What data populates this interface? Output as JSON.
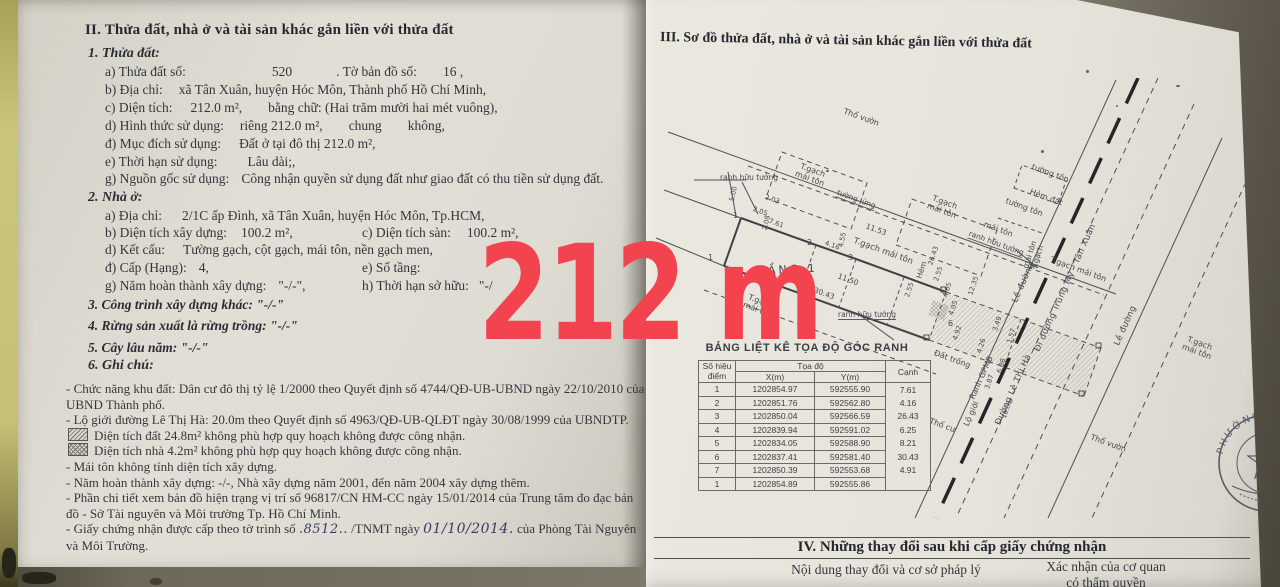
{
  "watermark": {
    "text": "212 m",
    "color": "#f3434f"
  },
  "left": {
    "title": "II. Thửa đất, nhà ở và tài sản khác gắn liền với thửa đất",
    "land_heading": "1. Thửa đất:",
    "land_a_label": "a) Thửa đất số:",
    "land_a_value": "520",
    "land_a_label2": ". Tờ bản đồ số:",
    "land_a_value2": "16 ,",
    "land_b_label": "b) Địa chỉ:",
    "land_b_value": "xã Tân Xuân, huyện Hóc Môn, Thành phố Hồ Chí Minh,",
    "land_c_label": "c) Diện tích:",
    "land_c_value": "212.0 m²,",
    "land_c_words": "bằng chữ: (Hai trăm mười hai mét vuông),",
    "land_d_label": "d) Hình thức sử dụng:",
    "land_d_rieng": "riêng 212.0 m²,",
    "land_d_chung": "chung",
    "land_d_khong": "không,",
    "land_dd_label": "đ) Mục đích sử dụng:",
    "land_dd_value": "Đất ở tại đô thị 212.0 m²,",
    "land_e_label": "e) Thời hạn sử dụng:",
    "land_e_value": "Lâu dài;,",
    "land_g_label": "g) Nguồn gốc sử dụng:",
    "land_g_value": "Công nhận quyền sử dụng đất như giao đất có thu tiền sử dụng đất.",
    "house_heading": "2. Nhà ở:",
    "house_a_label": "a) Địa chỉ:",
    "house_a_value": "2/1C ấp Đình, xã Tân Xuân, huyện Hóc Môn, Tp.HCM,",
    "house_b_label": "b) Diện tích xây dựng:",
    "house_b_value": "100.2 m²,",
    "house_c_label": "c) Diện tích sàn:",
    "house_c_value": "100.2 m²,",
    "house_d_label": "d) Kết cấu:",
    "house_d_value": "Tường gạch, cột gạch, mái tôn, nền gạch men,",
    "house_dd_label": "đ) Cấp (Hạng):",
    "house_dd_value": "4,",
    "house_e_label": "e) Số tầng:",
    "house_g_label": "g) Năm hoàn thành xây dựng:",
    "house_g_value": "\"-/-\",",
    "house_h_label": "h) Thời hạn sở hữu:",
    "house_h_value": "\"-/",
    "item3": "3. Công trình xây dựng khác: \"-/-\"",
    "item4": "4. Rừng sản xuất là rừng trồng: \"-/-\"",
    "item5": "5. Cây lâu năm: \"-/-\"",
    "item6": "6. Ghi chú:",
    "note1": "- Chức năng khu đất: Dân cư đô thị tỷ lệ 1/2000 theo Quyết định số 4744/QĐ-UB-UBND ngày 22/10/2010 của UBND Thành phố.",
    "note2": "- Lộ giới đường Lê Thị Hà: 20.0m theo Quyết định số 4963/QĐ-UB-QLĐT ngày 30/08/1999 của UBNDTP.",
    "note3": "Diện tích đất 24.8m² không phù hợp quy hoạch không được công nhận.",
    "note4": "Diện tích nhà 4.2m² không phù hợp quy hoạch không được công nhận.",
    "note5": "- Mái tôn không tính diện tích xây dựng.",
    "note6": "- Năm hoàn thành xây dựng: -/-, Nhà xây dựng năm 2001, đến năm 2004 xây dựng thêm.",
    "note7": "- Phần chi tiết xem bản đồ hiện trạng vị trí số 96817/CN HM-CC ngày 15/01/2014 của Trung tâm đo đạc bản đồ - Sở Tài nguyên và Môi trường Tp. Hồ Chí Minh.",
    "note8_pre": "- Giấy chứng nhận được cấp theo tờ trình số",
    "note8_hand1": ".8512..",
    "note8_mid": "/TNMT ngày",
    "note8_hand2": "01/10/2014.",
    "note8_post": "của Phòng Tài Nguyên",
    "note8_tail": "và Môi Trường."
  },
  "right": {
    "title": "III. Sơ đồ thửa đất, nhà ở và tài sản khác gắn liền với thửa đất",
    "table": {
      "title": "BẢNG LIỆT KÊ TỌA ĐỘ GÓC RANH",
      "h_point": "Số hiệu\nđiểm",
      "h_coord": "Tọa độ",
      "h_x": "X(m)",
      "h_y": "Y(m)",
      "h_edge": "Cạnh",
      "rows": [
        [
          "1",
          "1202854.97",
          "592555.90",
          "7.61"
        ],
        [
          "2",
          "1202851.76",
          "592562.80",
          "4.16"
        ],
        [
          "3",
          "1202850.04",
          "592566.59",
          "26.43"
        ],
        [
          "4",
          "1202839.94",
          "592591.02",
          "6.25"
        ],
        [
          "5",
          "1202834.05",
          "592588.90",
          "8.21"
        ],
        [
          "6",
          "1202837.41",
          "592581.40",
          "30.43"
        ],
        [
          "7",
          "1202850.39",
          "592553.68",
          "4.91"
        ],
        [
          "1",
          "1202854.89",
          "592555.86",
          ""
        ]
      ]
    },
    "sec4": {
      "title": "IV. Những thay đổi sau khi cấp giấy chứng nhận",
      "col1": "Nội dung thay đổi và cơ sở pháp lý",
      "col2a": "Xác nhận của cơ quan",
      "col2b": "có thẩm quyền"
    },
    "stamp_text": "PHƯỜNG HÒA BÌNH",
    "diagram": {
      "tho_vuon_top": "Thổ vườn",
      "hem_dat": "Hẻm đất",
      "tgach1": "T.gạch\nmái tôn",
      "tgach2": "T.gạch\nmái tôn",
      "tgach3": "T.gạch mái tôn",
      "tgach4": "T.gạch\nmái tôn",
      "tgach5": "T.gạch\nmái tôn",
      "tgach_plot": "T.gạch mái tôn",
      "mai_ton1": "mái tôn",
      "mai_ton2": "mái tôn\nT.gạch",
      "tuong_lung": "tường lửng",
      "tuong_ton1": "tường tôn",
      "tuong_ton2": "tường tôn",
      "ranh1": "ranh hữu tưởng",
      "ranh2": "ranh hữu tưởng",
      "ranh3": "ranh hữu tưởng",
      "tang1": "TẦNG 1",
      "le_duong1": "Lề đường",
      "le_duong2": "Lề đường",
      "duong_tm": "Đi đường Trung Mỹ - Tân Xuân",
      "duong_ltha": "Đường Lê Thị Hà",
      "ranh_gpmb": "Ranh GPMB",
      "lo_gioi": "Lộ giới",
      "hem": "Hẻm",
      "dat_trong": "Đất trống",
      "tho_cu": "Thổ cư",
      "tho_vuon_bot": "Thổ vườn",
      "p1": "1",
      "p2": "2",
      "p3": "3",
      "p6": "6",
      "p1b": "1",
      "m500": "5.00",
      "m761": "7.61",
      "m416": "4.16",
      "m203": "2.03",
      "m205": "2.05",
      "m208": "2.08",
      "m455": "4.55",
      "m1153": "11.53",
      "m1150": "11.50",
      "m3043": "30.43",
      "m2643": "26.43",
      "m255a": "2.55",
      "m255b": "2.55",
      "m465": "4.65",
      "m1235": "12.35",
      "m405": "4.05",
      "m492": "4.92",
      "m426": "4.26",
      "m349": "3.49",
      "m157": "1.57",
      "m688": "6.88",
      "m387": "3.87",
      "m1688": "16.88"
    }
  }
}
